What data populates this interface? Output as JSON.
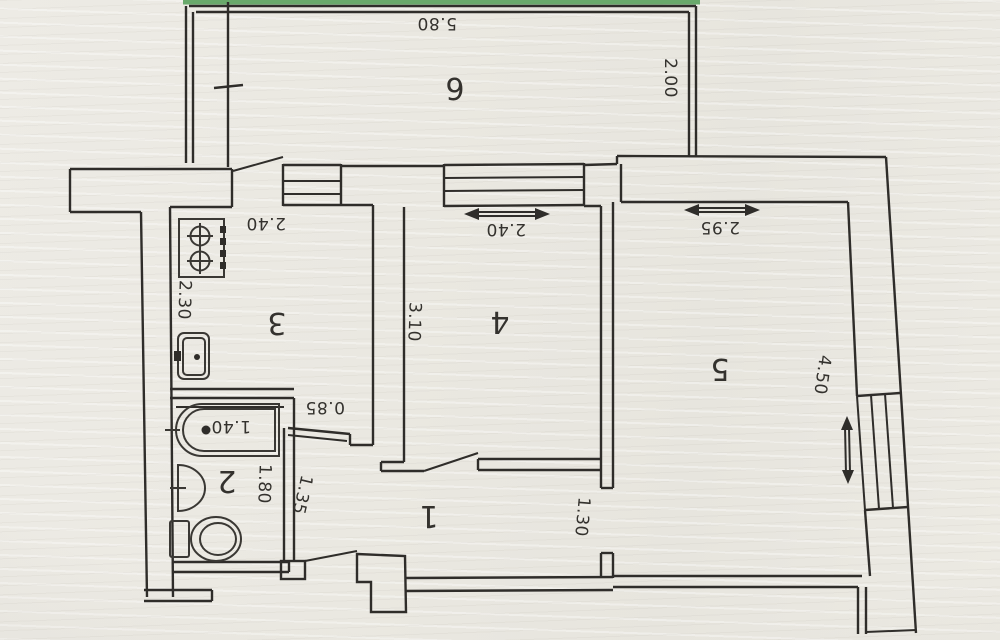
{
  "plan": {
    "title_note": "apartment floor plan (photo, rotated 180°)",
    "rooms": {
      "room1": "1",
      "room2": "2",
      "room3": "3",
      "room4": "4",
      "room5": "5",
      "room6": "6"
    },
    "dimensions": {
      "balcony_width": "5.80",
      "balcony_depth": "2.00",
      "kitchen_window": "2.40",
      "kitchen_width": "2.30",
      "room4_window": "2.40",
      "room4_width": "3.10",
      "room5_window": "2.95",
      "room5_depth": "4.50",
      "bathtub_length": "1.40",
      "bathroom_depth": "1.80",
      "niche_width": "0.85",
      "hall_width": "1.35",
      "room5_door": "1.30"
    },
    "colors": {
      "ink": "#2f2d2a",
      "paper": "#eae8e1",
      "accent_green": "#69a96b"
    }
  }
}
